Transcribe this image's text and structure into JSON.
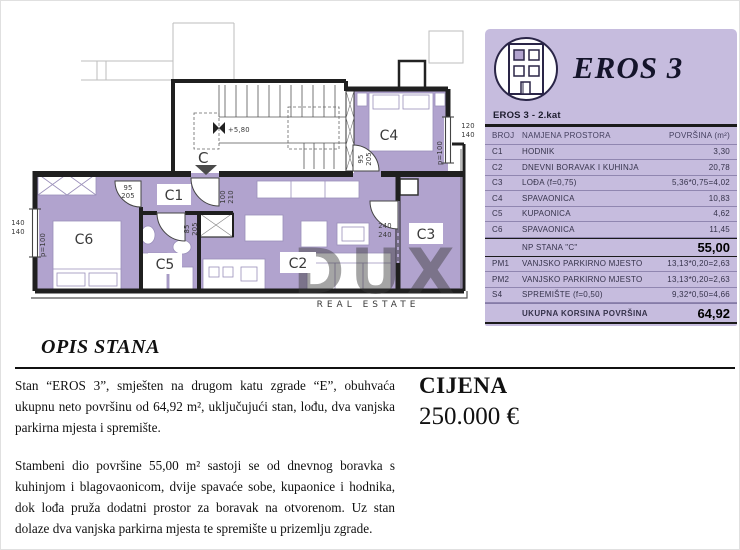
{
  "brand": {
    "title": "EROS 3",
    "floor_label": "EROS 3 - 2.kat"
  },
  "area_table": {
    "col_broj": "BROJ",
    "col_namjena": "NAMJENA PROSTORA",
    "col_povrsina": "POVRŠINA (m²)",
    "rows": [
      {
        "broj": "C1",
        "namjena": "HODNIK",
        "povrsina": "3,30"
      },
      {
        "broj": "C2",
        "namjena": "DNEVNI BORAVAK I KUHINJA",
        "povrsina": "20,78"
      },
      {
        "broj": "C3",
        "namjena": "LOĐA (f=0,75)",
        "povrsina": "5,36*0,75=4,02"
      },
      {
        "broj": "C4",
        "namjena": "SPAVAONICA",
        "povrsina": "10,83"
      },
      {
        "broj": "C5",
        "namjena": "KUPAONICA",
        "povrsina": "4,62"
      },
      {
        "broj": "C6",
        "namjena": "SPAVAONICA",
        "povrsina": "11,45"
      }
    ],
    "subtotal_label": "NP STANA \"C\"",
    "subtotal_value": "55,00",
    "extra_rows": [
      {
        "broj": "PM1",
        "namjena": "VANJSKO PARKIRNO MJESTO",
        "povrsina": "13,13*0,20=2,63"
      },
      {
        "broj": "PM2",
        "namjena": "VANJSKO PARKIRNO MJESTO",
        "povrsina": "13,13*0,20=2,63"
      },
      {
        "broj": "S4",
        "namjena": "SPREMIŠTE (f=0,50)",
        "povrsina": "9,32*0,50=4,66"
      }
    ],
    "total_label": "UKUPNA KORSINA POVRŠINA",
    "total_value": "64,92"
  },
  "description": {
    "heading": "OPIS STANA",
    "para1": "Stan “EROS 3”, smješten na drugom katu zgrade “E”, obuhvaća ukupnu neto površinu od 64,92 m², uključujući stan, lođu, dva vanjska parkirna mjesta i spremište.",
    "para2": "Stambeni dio površine 55,00 m² sastoji se od dnevnog boravka s kuhinjom i blagovaonicom, dvije spavaće sobe, kupaonice i hodnika, dok lođa pruža dodatni prostor za boravak na otvorenom. Uz stan dolaze dva vanjska parkirna mjesta te spremište u prizemlju zgrade."
  },
  "price": {
    "label": "CIJENA",
    "value": "250.000 €"
  },
  "floorplan": {
    "room_labels": {
      "c1": "C1",
      "c2": "C2",
      "c3": "C3",
      "c4": "C4",
      "c5": "C5",
      "c6": "C6"
    },
    "dims": {
      "c6_door": [
        "95",
        "205"
      ],
      "entry_door": [
        "100",
        "210"
      ],
      "c5_door": [
        "85",
        "205"
      ],
      "c4_door": [
        "95",
        "205"
      ],
      "c3_door": [
        "240",
        "240"
      ],
      "c4_window": [
        "120",
        "140"
      ],
      "c6_window": [
        "140",
        "140"
      ],
      "parapet_left": "p=100",
      "parapet_right": "p=100",
      "level": "+5,80",
      "entrance": "C"
    },
    "watermark": {
      "main": "DUX",
      "sub": "REAL ESTATE"
    }
  },
  "colors": {
    "panel_bg": "#c6bcde",
    "room_fill": "#b1a3ce",
    "wall": "#1f1f1f",
    "table_line": "#9186b3"
  }
}
